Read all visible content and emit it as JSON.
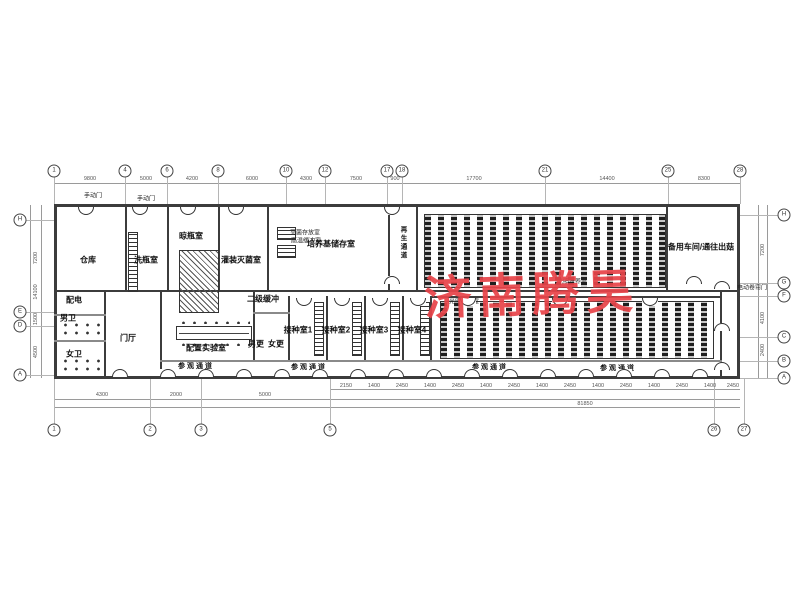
{
  "watermark": {
    "text": "济南腾昊",
    "color": "#e8444a"
  },
  "labels": {
    "rooms": [
      {
        "name": "warehouse",
        "text": "仓库",
        "x": 88,
        "y": 260
      },
      {
        "name": "bottle-washing-room",
        "text": "洗瓶室",
        "x": 146,
        "y": 260
      },
      {
        "name": "bottle-drying-room",
        "text": "晾瓶室",
        "x": 191,
        "y": 236
      },
      {
        "name": "filling-sterilization-room",
        "text": "灌装灭菌室",
        "x": 241,
        "y": 260
      },
      {
        "name": "medium-storage-room",
        "text": "培养基储存室",
        "x": 331,
        "y": 244
      },
      {
        "name": "spare-workshop",
        "text": "备用车间/通往出菇",
        "x": 701,
        "y": 247
      },
      {
        "name": "power-room",
        "text": "配电",
        "x": 74,
        "y": 300
      },
      {
        "name": "mens-toilet",
        "text": "男卫",
        "x": 68,
        "y": 318
      },
      {
        "name": "womens-toilet",
        "text": "女卫",
        "x": 74,
        "y": 354
      },
      {
        "name": "entrance-hall",
        "text": "门厅",
        "x": 128,
        "y": 338
      },
      {
        "name": "prep-lab",
        "text": "配置实验室",
        "x": 206,
        "y": 348
      },
      {
        "name": "secondary-buffer",
        "text": "二级缓冲",
        "x": 263,
        "y": 299
      },
      {
        "name": "mens-changing",
        "text": "男更",
        "x": 256,
        "y": 344
      },
      {
        "name": "womens-changing",
        "text": "女更",
        "x": 276,
        "y": 344
      },
      {
        "name": "inoculation-room-1",
        "text": "接种室1",
        "x": 298,
        "y": 330
      },
      {
        "name": "inoculation-room-2",
        "text": "接种室2",
        "x": 336,
        "y": 330
      },
      {
        "name": "inoculation-room-3",
        "text": "接种室3",
        "x": 374,
        "y": 330
      },
      {
        "name": "inoculation-room-4",
        "text": "接种室4",
        "x": 412,
        "y": 330
      }
    ],
    "small": [
      {
        "name": "sterile-storage",
        "text": "灭菌存放室",
        "x": 305,
        "y": 232
      },
      {
        "name": "high-temp-buffer",
        "text": "高温缓冲室",
        "x": 306,
        "y": 240
      },
      {
        "name": "light-culture-room-upper",
        "text": "光照培养室",
        "x": 572,
        "y": 281
      },
      {
        "name": "light-culture-room-lower",
        "text": "光照培养室",
        "x": 464,
        "y": 301
      },
      {
        "name": "manual-door-1",
        "text": "手动门",
        "x": 93,
        "y": 195
      },
      {
        "name": "manual-door-2",
        "text": "手动门",
        "x": 146,
        "y": 198
      },
      {
        "name": "electric-roller-door",
        "text": "电动卷帘门",
        "x": 752,
        "y": 287
      }
    ],
    "vertical": [
      {
        "name": "regen-corridor",
        "text": "再生通道",
        "x": 402,
        "y": 226
      }
    ],
    "corridors": [
      {
        "name": "visit-corridor-1",
        "text": "参观通道",
        "x": 196,
        "y": 366
      },
      {
        "name": "visit-corridor-2",
        "text": "参观通道",
        "x": 309,
        "y": 367
      },
      {
        "name": "visit-corridor-3",
        "text": "参观通道",
        "x": 490,
        "y": 367
      },
      {
        "name": "visit-corridor-4",
        "text": "参观通道",
        "x": 618,
        "y": 368
      }
    ]
  },
  "grid": {
    "top": [
      {
        "x": 54,
        "n": "1"
      },
      {
        "x": 125,
        "n": "4"
      },
      {
        "x": 167,
        "n": "6"
      },
      {
        "x": 218,
        "n": "8"
      },
      {
        "x": 286,
        "n": "10"
      },
      {
        "x": 325,
        "n": "12"
      },
      {
        "x": 387,
        "n": "17"
      },
      {
        "x": 402,
        "n": "18"
      },
      {
        "x": 545,
        "n": "21"
      },
      {
        "x": 668,
        "n": "25"
      },
      {
        "x": 740,
        "n": "28"
      }
    ],
    "bottom": [
      {
        "x": 54,
        "n": "1"
      },
      {
        "x": 150,
        "n": "2"
      },
      {
        "x": 201,
        "n": "3"
      },
      {
        "x": 330,
        "n": "5"
      },
      {
        "x": 714,
        "n": "26"
      },
      {
        "x": 744,
        "n": "27"
      }
    ],
    "left": [
      {
        "y": 220,
        "n": "H"
      },
      {
        "y": 312,
        "n": "E"
      },
      {
        "y": 326,
        "n": "D"
      },
      {
        "y": 375,
        "n": "A"
      }
    ],
    "right": [
      {
        "y": 215,
        "n": "H"
      },
      {
        "y": 283,
        "n": "G"
      },
      {
        "y": 296,
        "n": "F"
      },
      {
        "y": 337,
        "n": "C"
      },
      {
        "y": 361,
        "n": "B"
      },
      {
        "y": 378,
        "n": "A"
      }
    ]
  },
  "dims": {
    "top": [
      {
        "x": 90,
        "t": "9800"
      },
      {
        "x": 146,
        "t": "5000"
      },
      {
        "x": 192,
        "t": "4200"
      },
      {
        "x": 252,
        "t": "6000"
      },
      {
        "x": 306,
        "t": "4300"
      },
      {
        "x": 356,
        "t": "7500"
      },
      {
        "x": 395,
        "t": "900"
      },
      {
        "x": 474,
        "t": "17700"
      },
      {
        "x": 607,
        "t": "14400"
      },
      {
        "x": 704,
        "t": "8300"
      }
    ],
    "bottom_mid": [
      {
        "x": 102,
        "t": "4300"
      },
      {
        "x": 176,
        "t": "2000"
      },
      {
        "x": 265,
        "t": "5000"
      }
    ],
    "bottom_small": [
      {
        "x": 346,
        "t": "2150"
      },
      {
        "x": 374,
        "t": "1400"
      },
      {
        "x": 402,
        "t": "2450"
      },
      {
        "x": 430,
        "t": "1400"
      },
      {
        "x": 458,
        "t": "2450"
      },
      {
        "x": 486,
        "t": "1400"
      },
      {
        "x": 514,
        "t": "2450"
      },
      {
        "x": 542,
        "t": "1400"
      },
      {
        "x": 570,
        "t": "2450"
      },
      {
        "x": 598,
        "t": "1400"
      },
      {
        "x": 626,
        "t": "2450"
      },
      {
        "x": 654,
        "t": "1400"
      },
      {
        "x": 682,
        "t": "2450"
      },
      {
        "x": 710,
        "t": "1400"
      },
      {
        "x": 733,
        "t": "2450"
      }
    ],
    "bottom_overall": [
      {
        "x": 585,
        "t": "81850"
      }
    ],
    "left": [
      {
        "y": 258,
        "t": "7200"
      },
      {
        "y": 319,
        "t": "1500"
      },
      {
        "y": 352,
        "t": "4500"
      },
      {
        "y": 292,
        "t": "14100"
      }
    ],
    "right": [
      {
        "y": 250,
        "t": "7200"
      },
      {
        "y": 318,
        "t": "4100"
      },
      {
        "y": 350,
        "t": "2400"
      }
    ]
  },
  "doors": {
    "bottom_xs": [
      120,
      168,
      206,
      244,
      282,
      320,
      358,
      396,
      434,
      472,
      510,
      548,
      586,
      624,
      662,
      700
    ],
    "top_xs": [
      86,
      140,
      188,
      236
    ],
    "misc": [
      {
        "x": 392,
        "y": 205,
        "flip": true
      },
      {
        "x": 392,
        "y": 283,
        "flip": false
      },
      {
        "x": 694,
        "y": 283,
        "flip": false
      },
      {
        "x": 304,
        "y": 296,
        "flip": true
      },
      {
        "x": 342,
        "y": 296,
        "flip": true
      },
      {
        "x": 380,
        "y": 296,
        "flip": true
      },
      {
        "x": 418,
        "y": 296,
        "flip": true
      },
      {
        "x": 468,
        "y": 296,
        "flip": true
      },
      {
        "x": 560,
        "y": 296,
        "flip": true
      },
      {
        "x": 650,
        "y": 296,
        "flip": true
      },
      {
        "x": 722,
        "y": 288,
        "flip": false
      },
      {
        "x": 722,
        "y": 330,
        "flip": false
      },
      {
        "x": 722,
        "y": 369,
        "flip": false
      }
    ]
  }
}
